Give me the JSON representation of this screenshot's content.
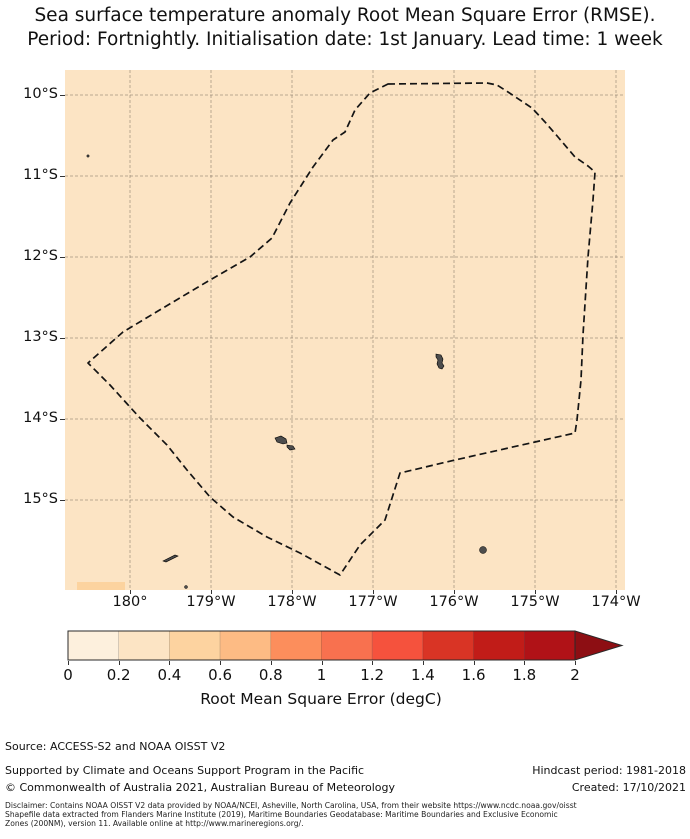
{
  "title": {
    "line1": "Sea surface temperature anomaly Root Mean Square Error (RMSE).",
    "line2": "Period: Fortnightly. Initialisation date: 1st January. Lead time: 1 week"
  },
  "map": {
    "background_color": "#fce4c4",
    "x_ticks": [
      {
        "label": "180°",
        "x": 130
      },
      {
        "label": "179°W",
        "x": 211
      },
      {
        "label": "178°W",
        "x": 292
      },
      {
        "label": "177°W",
        "x": 373
      },
      {
        "label": "176°W",
        "x": 454
      },
      {
        "label": "175°W",
        "x": 535
      },
      {
        "label": "174°W",
        "x": 616
      }
    ],
    "y_ticks": [
      {
        "label": "10°S",
        "y": 95
      },
      {
        "label": "11°S",
        "y": 176
      },
      {
        "label": "12°S",
        "y": 257
      },
      {
        "label": "13°S",
        "y": 338
      },
      {
        "label": "14°S",
        "y": 419
      },
      {
        "label": "15°S",
        "y": 500
      }
    ],
    "eez_boundary_px": [
      [
        323,
        14
      ],
      [
        422,
        13
      ],
      [
        432,
        15
      ],
      [
        443,
        22
      ],
      [
        467,
        38
      ],
      [
        480,
        52
      ],
      [
        493,
        67
      ],
      [
        510,
        87
      ],
      [
        523,
        96
      ],
      [
        530,
        102
      ],
      [
        528,
        130
      ],
      [
        523,
        187
      ],
      [
        518,
        265
      ],
      [
        516,
        310
      ],
      [
        512,
        350
      ],
      [
        510,
        363
      ],
      [
        470,
        372
      ],
      [
        390,
        390
      ],
      [
        335,
        403
      ],
      [
        320,
        450
      ],
      [
        295,
        475
      ],
      [
        275,
        505
      ],
      [
        235,
        483
      ],
      [
        202,
        467
      ],
      [
        168,
        447
      ],
      [
        145,
        427
      ],
      [
        122,
        400
      ],
      [
        102,
        375
      ],
      [
        75,
        348
      ],
      [
        45,
        315
      ],
      [
        23,
        293
      ],
      [
        58,
        262
      ],
      [
        98,
        238
      ],
      [
        145,
        210
      ],
      [
        185,
        187
      ],
      [
        207,
        168
      ],
      [
        225,
        133
      ],
      [
        248,
        97
      ],
      [
        268,
        70
      ],
      [
        280,
        62
      ],
      [
        290,
        40
      ],
      [
        305,
        23
      ]
    ],
    "islands": {
      "color": "#4d4d4d",
      "paths": [
        "M371,284 l5,1 l2,4 l-1,4 l2,3 l-2,3 l-3,-1 l-2,-4 l1,-4 l-2,-3 z",
        "M210,368 l6,-2 l5,3 l1,4 l-4,1 l-6,-2 z",
        "M222,375 l6,1 l2,3 l-5,1 l-3,-3 z",
        "M98,491 l12,-6 l3,1 l-12,6 z"
      ],
      "dots": [
        {
          "cx": 23,
          "cy": 86,
          "r": 1.2
        },
        {
          "cx": 418,
          "cy": 480,
          "r": 3.5
        },
        {
          "cx": 121,
          "cy": 517,
          "r": 1.5
        }
      ]
    },
    "hot_cell": {
      "x": 12,
      "y": 512,
      "w": 48,
      "h": 8,
      "color": "#fcd39f"
    }
  },
  "colorbar": {
    "title": "Root Mean Square Error (degC)",
    "tick_labels": [
      "0",
      "0.2",
      "0.4",
      "0.6",
      "0.8",
      "1",
      "1.2",
      "1.4",
      "1.6",
      "1.8",
      "2"
    ],
    "bins": [
      {
        "range": "0-0.2",
        "color": "#fdf0dd"
      },
      {
        "range": "0.2-0.4",
        "color": "#fce4c4"
      },
      {
        "range": "0.4-0.6",
        "color": "#fdd3a0"
      },
      {
        "range": "0.6-0.8",
        "color": "#fdbb84"
      },
      {
        "range": "0.8-1",
        "color": "#fc8e5c"
      },
      {
        "range": "1-1.2",
        "color": "#f8714f"
      },
      {
        "range": "1.2-1.4",
        "color": "#f5523d"
      },
      {
        "range": "1.4-1.6",
        "color": "#d93425"
      },
      {
        "range": "1.6-1.8",
        "color": "#c11c18"
      },
      {
        "range": "1.8-2",
        "color": "#b01217"
      }
    ],
    "over_color": "#8d0e13"
  },
  "footer": {
    "source": "Source: ACCESS-S2 and NOAA OISST V2",
    "supported": "Supported by Climate and Oceans Support Program in the Pacific",
    "hindcast": "Hindcast period: 1981-2018",
    "copyright": "© Commonwealth of Australia 2021, Australian Bureau of Meteorology",
    "created": "Created: 17/10/2021",
    "disclaimer_line1": "Disclaimer: Contains NOAA OISST V2 data provided by NOAA/NCEI, Asheville, North Carolina, USA, from their website https://www.ncdc.noaa.gov/oisst",
    "disclaimer_line2": "Shapefile data extracted from Flanders Marine Institute (2019), Maritime Boundaries Geodatabase: Maritime Boundaries and Exclusive Economic",
    "disclaimer_line3": "Zones (200NM), version 11. Available online at http://www.marineregions.org/."
  },
  "chart_data": {
    "type": "heatmap",
    "title": "Sea surface temperature anomaly Root Mean Square Error (RMSE). Period: Fortnightly. Initialisation date: 1st January. Lead time: 1 week",
    "x_axis": {
      "label": "",
      "tick_labels": [
        "180°",
        "179°W",
        "178°W",
        "177°W",
        "176°W",
        "175°W",
        "174°W"
      ],
      "range_deg": [
        "179.2°E",
        "173.1°W"
      ]
    },
    "y_axis": {
      "label": "",
      "tick_labels": [
        "10°S",
        "11°S",
        "12°S",
        "13°S",
        "14°S",
        "15°S"
      ],
      "range_deg": [
        "9.7°S",
        "16.1°S"
      ]
    },
    "colorbar": {
      "label": "Root Mean Square Error (degC)",
      "ticks": [
        0,
        0.2,
        0.4,
        0.6,
        0.8,
        1,
        1.2,
        1.4,
        1.6,
        1.8,
        2
      ],
      "extend": "max"
    },
    "field_summary": "RMSE is uniform in the 0.2-0.4 degC bin over the whole shown domain; one grid cell near 180°, 16°S falls in the 0.4-0.6 degC bin",
    "overlays": [
      "dashed EEZ boundary polygon",
      "small grey islands (Wallis, Futuna/Alofi and nearby islets)"
    ]
  }
}
